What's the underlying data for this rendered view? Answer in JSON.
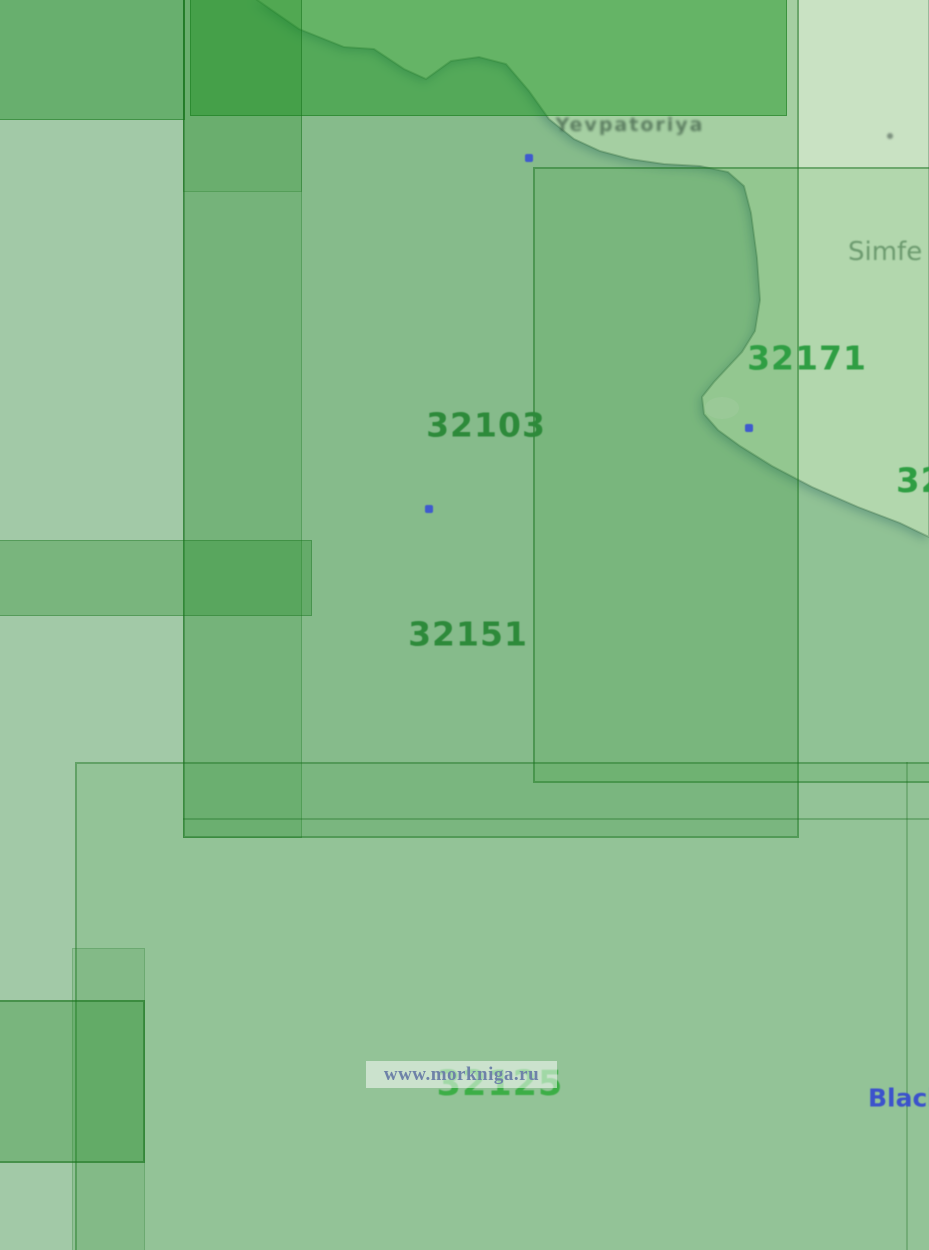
{
  "map": {
    "chart_numbers": [
      {
        "label": "32103",
        "color": "#2d8a3a"
      },
      {
        "label": "32151",
        "color": "#2d8a3a"
      },
      {
        "label": "32171",
        "color": "#2f9e43"
      },
      {
        "label": "32125",
        "color": "#3cae46"
      },
      {
        "label": "32",
        "color": "#2f9e43"
      }
    ],
    "place_labels": [
      {
        "text": "Yevpatoriya",
        "color": "#3e5c46"
      },
      {
        "text": "Simfe",
        "color": "#5f8f63"
      },
      {
        "text": "Black",
        "color": "#3c52cc"
      }
    ],
    "markers": [
      {
        "x": 529,
        "y": 158,
        "kind": "chart-point"
      },
      {
        "x": 429,
        "y": 509,
        "kind": "chart-point"
      },
      {
        "x": 749,
        "y": 428,
        "kind": "chart-point"
      },
      {
        "x": 891,
        "y": 137,
        "kind": "speck"
      }
    ],
    "colors": {
      "sea": "#a2c9a7",
      "land": "#c9e2c3",
      "lake": "#d4e6cf"
    }
  },
  "watermark": {
    "text": "www.morkniga.ru",
    "color": "#6e82a8",
    "background": "rgba(255,255,255,0.52)"
  }
}
